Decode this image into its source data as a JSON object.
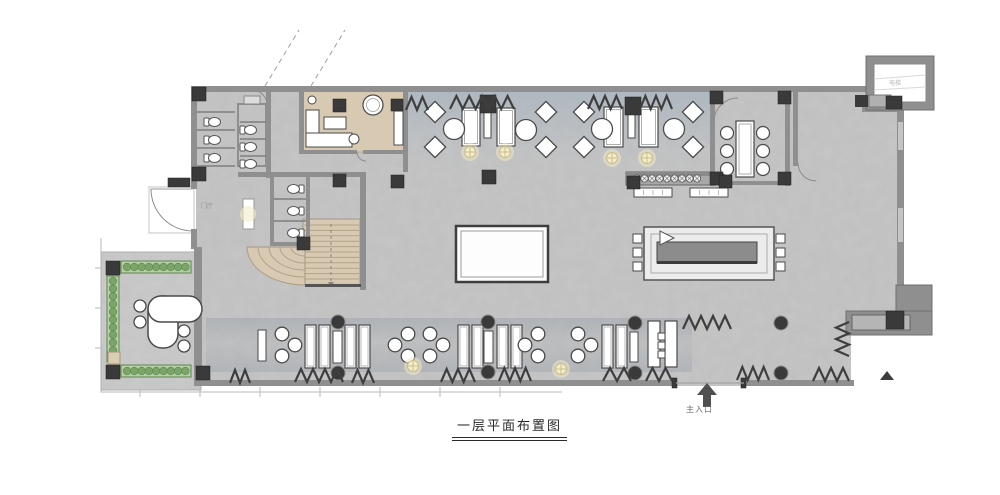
{
  "title": "一层平面布置图",
  "labels": {
    "main_entrance": "主入口",
    "foyer": "门厅",
    "elevator": "电梯"
  },
  "colors": {
    "paper": "#ffffff",
    "floor": "#c6c6c6",
    "terrace": "#cbcbcb",
    "wall": "#8f8f8f",
    "wall_dark": "#555555",
    "column": "#3a3a3a",
    "furniture_fill": "#ffffff",
    "furniture_stroke": "#4a4a4a",
    "wood": "#d8c9b3",
    "wood_line": "#b2a28a",
    "plant": "#b6cfa3",
    "plant_dot": "#7ba568",
    "plant_stroke": "#5d8550",
    "lamp": "#f3ecc6",
    "zigzag": "#3e3e3e",
    "carpet_blue": "#9fb0bf",
    "carpet_gray": "#8e98a3",
    "boundary": "#b8b8b8",
    "text_dark": "#2b2b2b",
    "text_gray": "#6e6e6e"
  }
}
